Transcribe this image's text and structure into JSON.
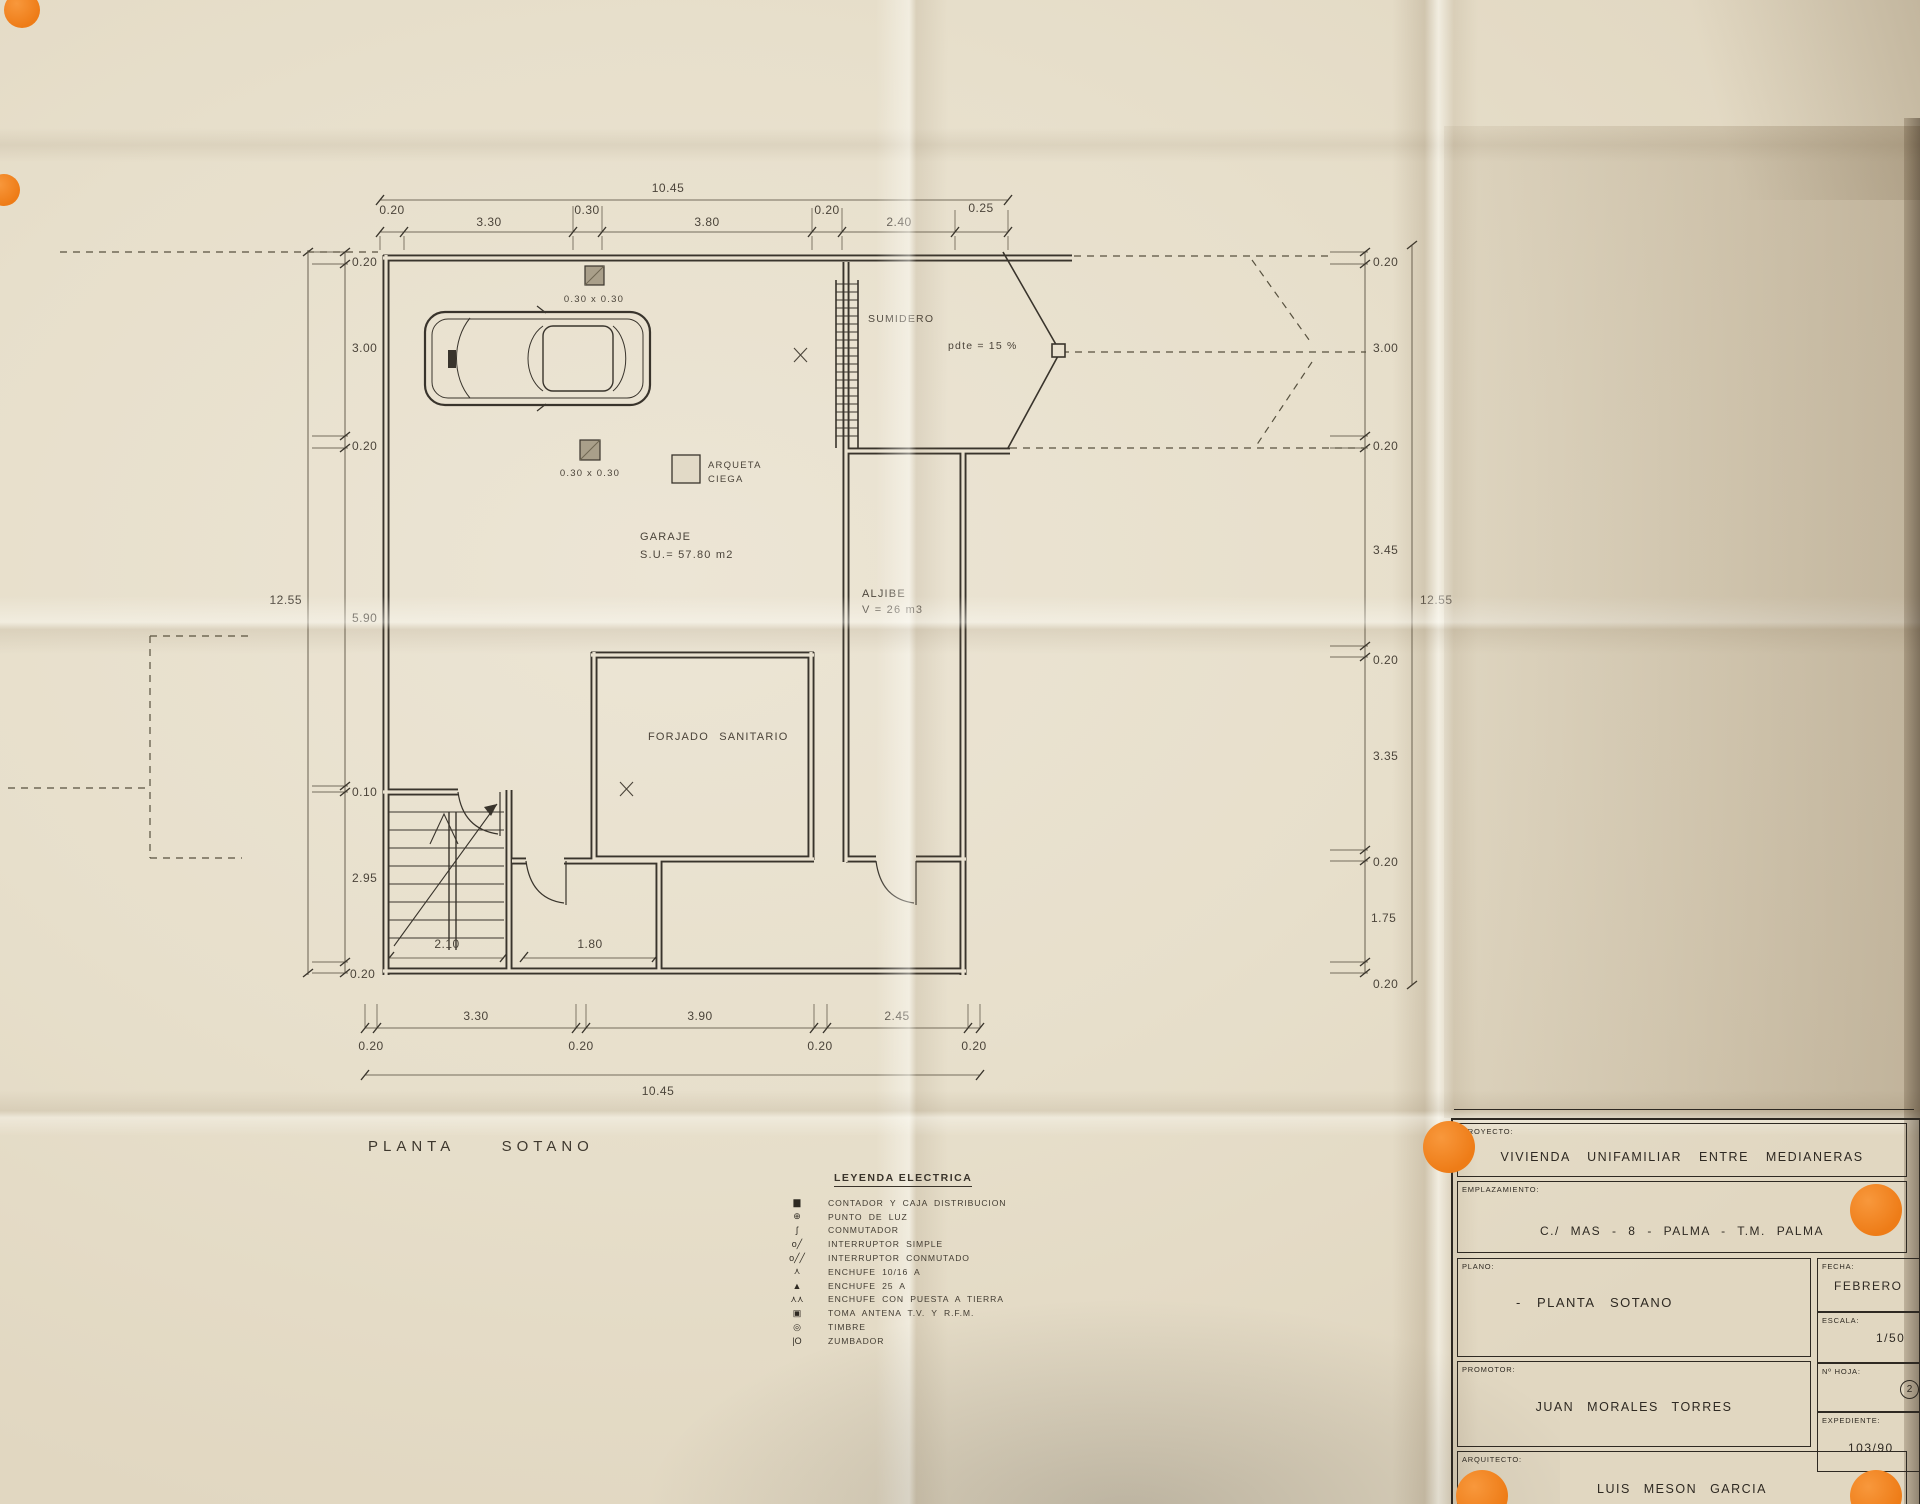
{
  "plan": {
    "title_word1": "PLANTA",
    "title_word2": "SOTANO",
    "rooms": {
      "garaje_name": "GARAJE",
      "garaje_area": "S.U.= 57.80 m2",
      "aljibe_name": "ALJIBE",
      "aljibe_vol": "V = 26 m3",
      "forjado": "FORJADO SANITARIO",
      "sumidero": "SUMIDERO",
      "pendiente": "pdte = 15 %",
      "arqueta_line1": "ARQUETA",
      "arqueta_line2": "CIEGA",
      "pilar_superior": "0.30 x 0.30",
      "pilar_central": "0.30 x 0.30"
    }
  },
  "dims": {
    "top": [
      "0.20",
      "3.30",
      "0.30",
      "3.80",
      "0.20",
      "2.40",
      "0.25"
    ],
    "top_total": "10.45",
    "bottom": [
      "0.20",
      "3.30",
      "0.20",
      "3.90",
      "0.20",
      "2.45",
      "0.20"
    ],
    "bottom_total": "10.45",
    "left": [
      "0.20",
      "3.00",
      "0.20",
      "5.90",
      "0.10",
      "2.95",
      "0.20"
    ],
    "left_total": "12.55",
    "right": [
      "0.20",
      "3.00",
      "0.20",
      "3.45",
      "0.20",
      "3.35",
      "0.20",
      "1.75",
      "0.20"
    ],
    "right_total": "12.55",
    "escalera": "2.10",
    "cuarto": "1.80"
  },
  "legend": {
    "title": "LEYENDA ELECTRICA",
    "items": [
      {
        "glyph": "▆",
        "name": "contador-icon",
        "label": "CONTADOR Y CAJA DISTRIBUCION"
      },
      {
        "glyph": "⊕",
        "name": "punto-luz-icon",
        "label": "PUNTO DE LUZ"
      },
      {
        "glyph": "ʃ",
        "name": "conmutador-icon",
        "label": "CONMUTADOR"
      },
      {
        "glyph": "o╱",
        "name": "interruptor-simple-icon",
        "label": "INTERRUPTOR SIMPLE"
      },
      {
        "glyph": "o╱╱",
        "name": "interruptor-conmutado-icon",
        "label": "INTERRUPTOR CONMUTADO"
      },
      {
        "glyph": "⋏",
        "name": "enchufe-icon",
        "label": "ENCHUFE 10/16 A"
      },
      {
        "glyph": "▲",
        "name": "enchufe-25-icon",
        "label": "ENCHUFE 25 A"
      },
      {
        "glyph": "⋏⋏",
        "name": "enchufe-tierra-icon",
        "label": "ENCHUFE CON PUESTA A TIERRA"
      },
      {
        "glyph": "▣",
        "name": "toma-antena-icon",
        "label": "TOMA ANTENA T.V. Y R.F.M."
      },
      {
        "glyph": "◎",
        "name": "timbre-icon",
        "label": "TIMBRE"
      },
      {
        "glyph": "|O",
        "name": "zumbador-icon",
        "label": "ZUMBADOR"
      }
    ]
  },
  "title_block": {
    "proyecto_label": "PROYECTO:",
    "proyecto_value": "VIVIENDA UNIFAMILIAR ENTRE MEDIANERAS",
    "emplazamiento_label": "EMPLAZAMIENTO:",
    "emplazamiento_value": "C./ MAS - 8 - PALMA - T.M. PALMA",
    "plano_label": "PLANO:",
    "plano_value": "- PLANTA SOTANO",
    "fecha_label": "FECHA:",
    "fecha_value": "FEBRERO",
    "escala_label": "ESCALA:",
    "escala_value": "1/50",
    "hoja_label": "Nº HOJA:",
    "hoja_value": "2",
    "promotor_label": "PROMOTOR:",
    "promotor_value": "JUAN MORALES TORRES",
    "expediente_label": "EXPEDIENTE:",
    "expediente_value": "103/90",
    "arquitecto_label": "ARQUITECTO:",
    "arquitecto_value": "LUIS MESON GARCIA"
  },
  "colors": {
    "sticker": "#ee7c17",
    "ink": "#39342c",
    "paper": "#e9e1cf"
  }
}
